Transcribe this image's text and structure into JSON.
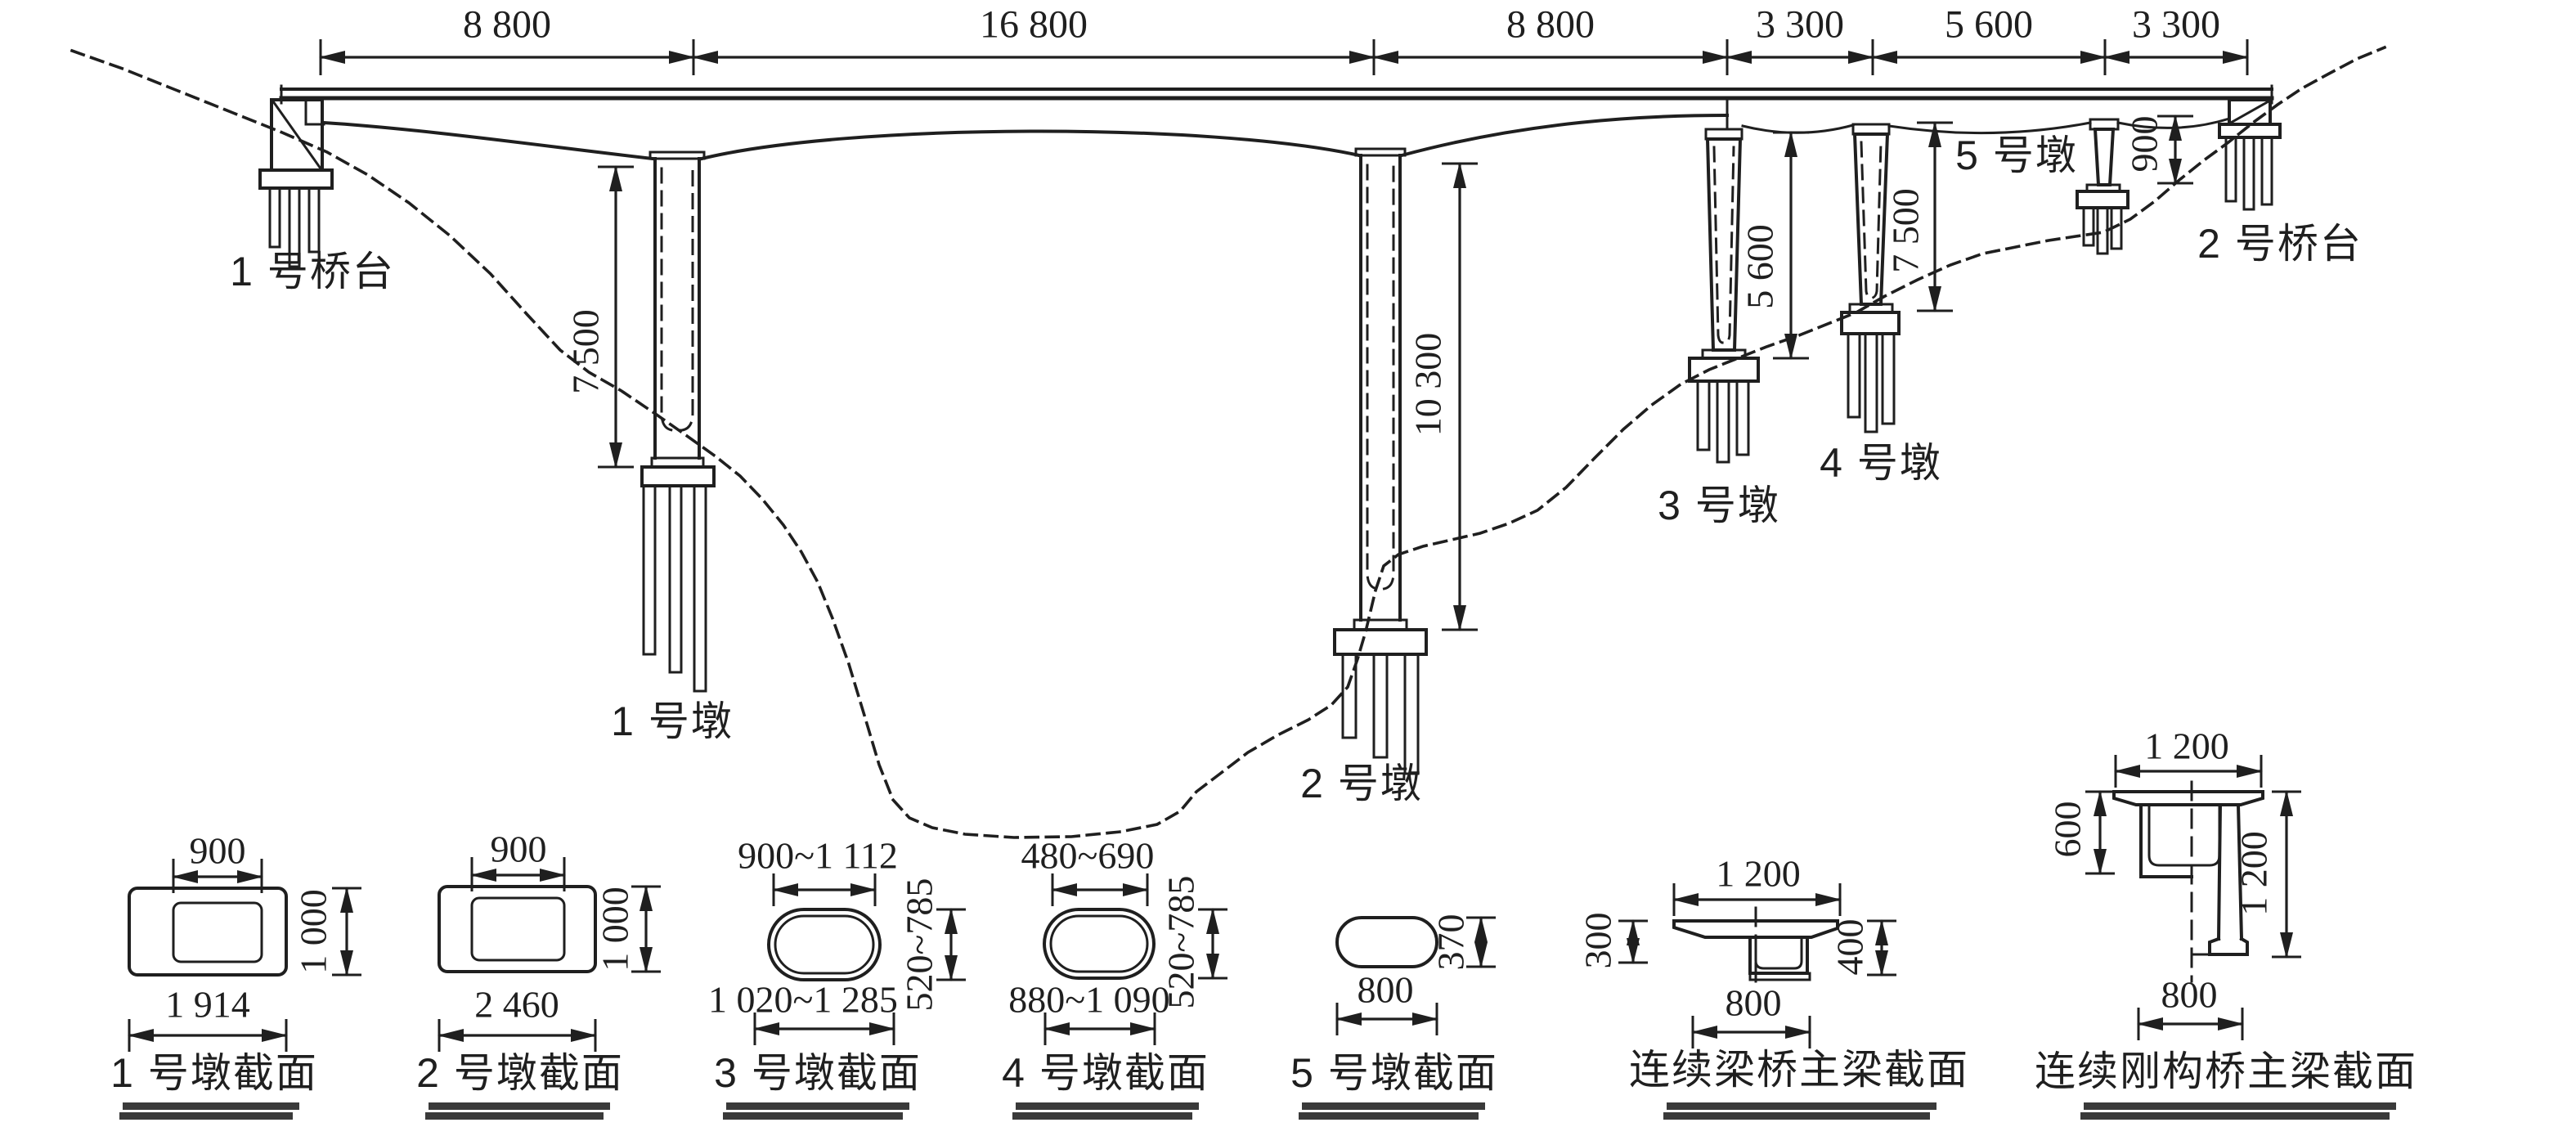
{
  "colors": {
    "ink": "#1f1f1f",
    "background": "#ffffff",
    "underline_bar": "#3a3a3a"
  },
  "elevation": {
    "span_dims": {
      "s1": "8 800",
      "s2": "16 800",
      "s3": "8 800",
      "s4": "3 300",
      "s5": "5 600",
      "s6": "3 300"
    },
    "height_dims": {
      "pier1": "7 500",
      "pier2": "10 300",
      "pier3": "5 600",
      "pier4": "7 500",
      "abutment2_side": "900"
    },
    "labels": {
      "abutment1": "1 号桥台",
      "pier1": "1 号墩",
      "pier2": "2 号墩",
      "pier3": "3 号墩",
      "pier4": "4 号墩",
      "pier5": "5 号墩",
      "abutment2": "2 号桥台"
    }
  },
  "sections": {
    "s1": {
      "label": "1 号墩截面",
      "top": "900",
      "side": "1 000",
      "bottom": "1 914"
    },
    "s2": {
      "label": "2 号墩截面",
      "top": "900",
      "side": "1 000",
      "bottom": "2 460"
    },
    "s3": {
      "label": "3 号墩截面",
      "top": "900~1 112",
      "side": "520~785",
      "bottom": "1 020~1 285"
    },
    "s4": {
      "label": "4 号墩截面",
      "top": "480~690",
      "side": "520~785",
      "bottom": "880~1 090"
    },
    "s5": {
      "label": "5 号墩截面",
      "side": "370",
      "bottom": "800"
    },
    "s6": {
      "label": "连续梁桥主梁截面",
      "top": "1 200",
      "left": "300",
      "right": "400",
      "bottom": "800"
    },
    "s7": {
      "label": "连续刚构桥主梁截面",
      "top": "1 200",
      "left": "600",
      "right": "1 200",
      "bottom": "800"
    }
  }
}
